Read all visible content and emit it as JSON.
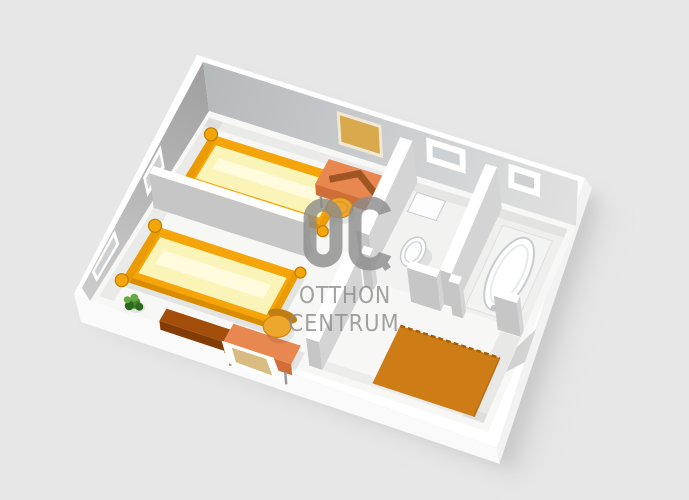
{
  "image_type": "3d-floor-plan-rendering",
  "watermark": {
    "logo_text": "OC",
    "line1": "OTTHON",
    "line2": "CENTRUM",
    "color": "#8c8c8c",
    "opacity": 0.8
  },
  "scene": {
    "background": "#e7e7e7",
    "palette": {
      "wall_top": "#ffffff",
      "wall_face_nw_dark": "#9f9f9f",
      "wall_face_nw_light": "#cbcbcb",
      "wall_face_ne_dark": "#b5b9bc",
      "wall_face_ne_light": "#e0e0e0",
      "wall_face": "#c6c6c6",
      "wall_face_side": "#d4d4d4",
      "outer_face_ws": "#fafafa",
      "outer_face_es": "#f2f2f2",
      "door_opening": "#cbcbcb",
      "floor": "#f7f7f5",
      "window_frame": "#ffffff",
      "window_pane": "#ced1d3",
      "window_sill_tan": "#d8bc82",
      "bed_frame": "#f5a509",
      "bed_frame_dark": "#d98c00",
      "bed_frame_mid": "#eb9b04",
      "mattress": "#fbf4b8",
      "mattress_hi": "#fffce2",
      "bed_post": "#f3a50a",
      "bed_post_rim": "#bd7e00",
      "desk_top": "#e8874f",
      "desk_front": "#cf6e38",
      "desk_leg": "#9a9a9a",
      "laptop": "#a05622",
      "corkboard": "#d9a94e",
      "corkboard_frame": "#f0e9d6",
      "stool": "#eca72c",
      "stool_rim": "#c58112",
      "sideboard_top": "#a34d0b",
      "sideboard_front": "#833c05",
      "chair_seat": "#eca72c",
      "chair_back": "#bf7d12",
      "plant_dark": "#2d6a1c",
      "plant_mid": "#44842c",
      "plant_light": "#63a845",
      "rug": "#cd7c16",
      "rug_edge": "#a35e07",
      "porcelain": "#fdfdfd",
      "porcelain_shade": "#c9ccd0",
      "tub_deck": "#f3f3f2",
      "shadow": "#bdbdbd"
    },
    "rooms": [
      {
        "id": "bedroom-1",
        "label": "upper bedroom with single bed, desk, corkboard and stool"
      },
      {
        "id": "bedroom-2",
        "label": "lower bedroom with single bed, sideboard, desk, chair and plant"
      },
      {
        "id": "wc",
        "label": "toilet room with window"
      },
      {
        "id": "bathroom",
        "label": "bathroom with bathtub and window"
      },
      {
        "id": "hall",
        "label": "hallway with orange rug"
      }
    ],
    "walls": [
      {
        "id": "wall-bedroom-divider",
        "u1": 0.018,
        "v1": 0.468,
        "u2": 0.42,
        "v2": 0.503
      },
      {
        "id": "wall-bedroom1-right",
        "u1": 0.545,
        "v1": 0.03,
        "u2": 0.578,
        "v2": 0.468
      },
      {
        "id": "wall-bedroom2-right",
        "u1": 0.545,
        "v1": 0.565,
        "u2": 0.578,
        "v2": 0.968
      },
      {
        "id": "wall-wc-bathroom",
        "u1": 0.775,
        "v1": 0.03,
        "u2": 0.805,
        "v2": 0.518
      },
      {
        "id": "wall-wc-front-left",
        "u1": 0.578,
        "v1": 0.518,
        "u2": 0.602,
        "v2": 0.552
      },
      {
        "id": "wall-wc-front-right",
        "u1": 0.698,
        "v1": 0.518,
        "u2": 0.775,
        "v2": 0.552
      },
      {
        "id": "wall-bath-front-left",
        "u1": 0.805,
        "v1": 0.518,
        "u2": 0.832,
        "v2": 0.552
      },
      {
        "id": "wall-bath-front-right",
        "u1": 0.922,
        "v1": 0.518,
        "u2": 0.982,
        "v2": 0.552
      }
    ],
    "windows": [
      {
        "id": "window-bedroom1",
        "wall": "NW",
        "t1": 0.355,
        "t2": 0.5,
        "f1": 0.3,
        "f2": 0.92
      },
      {
        "id": "window-bedroom2",
        "wall": "NW",
        "t1": 0.735,
        "t2": 0.925,
        "f1": 0.3,
        "f2": 0.92
      },
      {
        "id": "window-wc",
        "wall": "NE",
        "t1": 0.595,
        "t2": 0.7,
        "f1": 0.38,
        "f2": 0.9
      },
      {
        "id": "window-bathroom",
        "wall": "NE",
        "t1": 0.815,
        "t2": 0.9,
        "f1": 0.38,
        "f2": 0.9
      }
    ],
    "furniture": [
      {
        "type": "corkboard",
        "id": "corkboard-bedroom1",
        "phase": "far",
        "t1": 0.355,
        "t2": 0.475,
        "f1": 0.16,
        "f2": 0.86
      },
      {
        "type": "bed",
        "id": "bed-bedroom1",
        "phase": "far",
        "u1": 0.045,
        "v1": 0.1,
        "u2": 0.42,
        "v2": 0.37
      },
      {
        "type": "desk",
        "id": "desk-bedroom1",
        "phase": "far",
        "u1": 0.345,
        "v1": 0.048,
        "u2": 0.52,
        "v2": 0.175,
        "laptop": true
      },
      {
        "type": "stool",
        "id": "stool-bedroom1",
        "phase": "far",
        "u": 0.43,
        "v": 0.245
      },
      {
        "type": "toilet",
        "id": "toilet-wc",
        "phase": "far",
        "u": 0.648,
        "v": 0.335
      },
      {
        "type": "bathtub",
        "id": "bathtub",
        "phase": "far",
        "u1": 0.825,
        "v1": 0.1,
        "u2": 0.958,
        "v2": 0.5
      },
      {
        "type": "rug",
        "id": "rug-hall",
        "phase": "near",
        "u1": 0.7,
        "v1": 0.67,
        "u2": 0.955,
        "v2": 0.955
      },
      {
        "type": "bed",
        "id": "bed-bedroom2",
        "phase": "near",
        "u1": 0.045,
        "v1": 0.58,
        "u2": 0.42,
        "v2": 0.865
      },
      {
        "type": "sideboard",
        "id": "sideboard-bedroom2",
        "phase": "near",
        "u1": 0.175,
        "v1": 0.925,
        "u2": 0.335,
        "v2": 0.988
      },
      {
        "type": "desk",
        "id": "desk-bedroom2",
        "phase": "near",
        "u1": 0.335,
        "v1": 0.895,
        "u2": 0.505,
        "v2": 0.988,
        "laptop": false
      },
      {
        "type": "chair",
        "id": "chair-bedroom2",
        "phase": "near",
        "u": 0.432,
        "v": 0.845
      },
      {
        "type": "plant",
        "id": "plant-bedroom2",
        "phase": "near",
        "u": 0.1,
        "v": 0.945
      },
      {
        "type": "window-low",
        "id": "window-bedroom2-front",
        "phase": "near",
        "t1": 0.33,
        "t2": 0.46
      }
    ]
  }
}
